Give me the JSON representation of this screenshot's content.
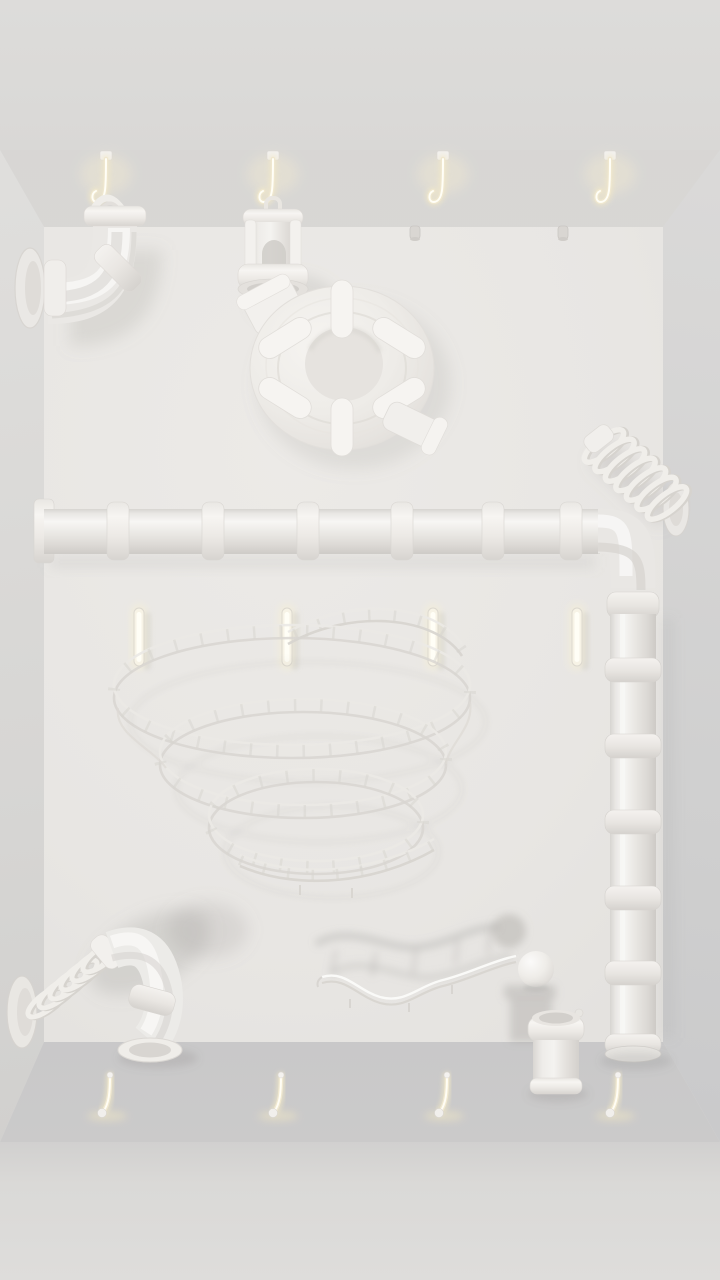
{
  "scene": {
    "title": "white-room-marble-run",
    "description": "Monochrome 3D room with white pipe and track pieces mounted on glowing hooks",
    "room_colors": {
      "back_wall": "#e9e7e4",
      "ceiling": "#d8d7d5",
      "left_wall": "#d9d8d6",
      "right_wall": "#d2d1d1",
      "floor": "#c7c7c9",
      "front_apron": "#dadad8",
      "outer_top": "#dcdbd9"
    },
    "glow_color": "#fdf6dd",
    "piece_color": "#f1efec"
  },
  "hooks": {
    "ceiling": {
      "xs": [
        106,
        273,
        443,
        610
      ]
    },
    "floor": {
      "xs": [
        106,
        277,
        443,
        614
      ]
    },
    "wall_pegs": {
      "xs": [
        139,
        287,
        433,
        577
      ],
      "y": 608
    },
    "wall_stubs": {
      "xs": [
        415,
        563
      ],
      "y": 226
    }
  },
  "pipes": {
    "horizontal": {
      "coupling_xs": [
        118,
        213,
        308,
        402,
        493,
        571
      ]
    },
    "vertical": {
      "coupling_ys": [
        658,
        734,
        810,
        886,
        961
      ]
    }
  },
  "pieces": [
    {
      "id": "elbow-pipe-top-left",
      "label": "elbow pipe hanging from ceiling hook"
    },
    {
      "id": "hanging-cup",
      "label": "bucket hanging from ceiling hook"
    },
    {
      "id": "spiral-ring-slide",
      "label": "circular spiral slide"
    },
    {
      "id": "wall-spring-right",
      "label": "coil spring mounted on right wall"
    },
    {
      "id": "long-pipe",
      "label": "long pipe bending down the right side"
    },
    {
      "id": "wire-helix-slide",
      "label": "wireframe helix track"
    },
    {
      "id": "spring-elbow-bottom-left",
      "label": "spring with elbow pipe on left wall"
    },
    {
      "id": "wavy-rail-track",
      "label": "wavy rail track"
    },
    {
      "id": "ball",
      "label": "white ball"
    },
    {
      "id": "floor-cup",
      "label": "cup standing on floor"
    }
  ]
}
